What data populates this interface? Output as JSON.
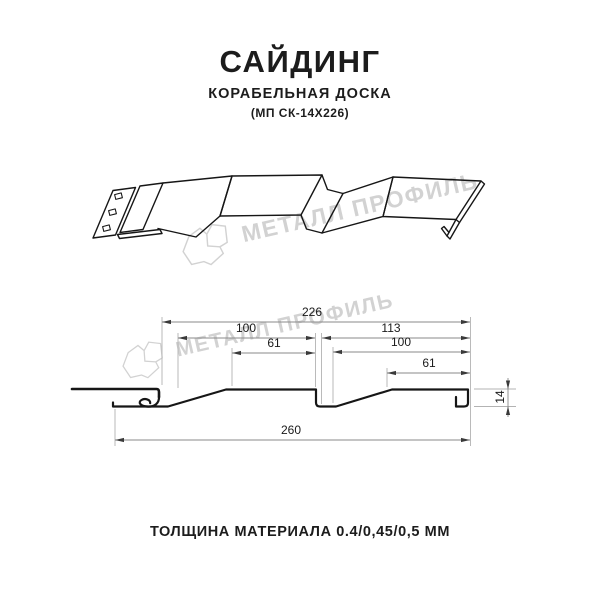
{
  "header": {
    "title": "САЙДИНГ",
    "subtitle": "КОРАБЕЛЬНАЯ ДОСКА",
    "model": "(МП СК-14Х226)"
  },
  "watermark": {
    "brand": "МЕТАЛЛ ПРОФИЛЬ",
    "logo_icon": "metal-profile-logo"
  },
  "section": {
    "dims": {
      "cover_width": "226",
      "board1_pitch": "100",
      "board1_flat": "61",
      "board2_pitch": "113",
      "board2_width": "100",
      "board2_flat": "61",
      "overall_width": "260",
      "profile_depth": "14"
    }
  },
  "footer": {
    "thickness_note": "ТОЛЩИНА МАТЕРИАЛА 0.4/0,45/0,5 ММ"
  },
  "colors": {
    "line": "#161616",
    "dimension_line": "#8a8a8a",
    "extension_line": "#b3b3b3",
    "dimension_arrow": "#3a3a3a",
    "watermark": "#d2d2d2",
    "text": "#1c1c1c",
    "background": "#ffffff"
  }
}
